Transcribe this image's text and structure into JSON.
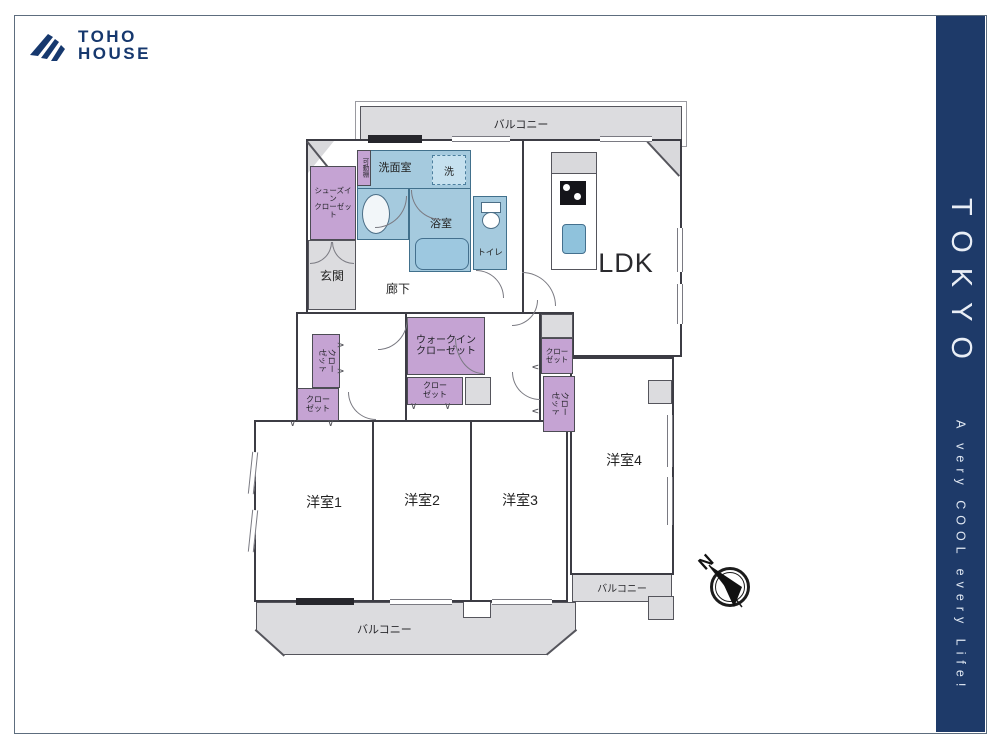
{
  "brand": {
    "line1": "TOHO",
    "line2": "HOUSE"
  },
  "banner": {
    "title": "TOKYO",
    "tagline": "A very COOL every Life!"
  },
  "plan": {
    "balcony": "バルコニー",
    "ldk": "LDK",
    "entrance": "玄関",
    "hallway": "廊下",
    "washroom": "洗面室",
    "laundry": "洗",
    "bathroom": "浴室",
    "toilet": "トイレ",
    "shoes_in_closet": {
      "line1": "シューズイン",
      "line2": "クローゼット"
    },
    "movable_shelf": "可動棚",
    "walk_in_closet": {
      "line1": "ウォークイン",
      "line2": "クローゼット"
    },
    "closet": {
      "line1": "クロー",
      "line2": "ゼット"
    },
    "room1": "洋室1",
    "room2": "洋室2",
    "room3": "洋室3",
    "room4": "洋室4",
    "compass_north": "N"
  },
  "colors": {
    "brand_navy": "#1e3a69",
    "wet_area_blue": "#a5cade",
    "closet_purple": "#c5a3d3",
    "balcony_gray": "#dcdcdf"
  }
}
